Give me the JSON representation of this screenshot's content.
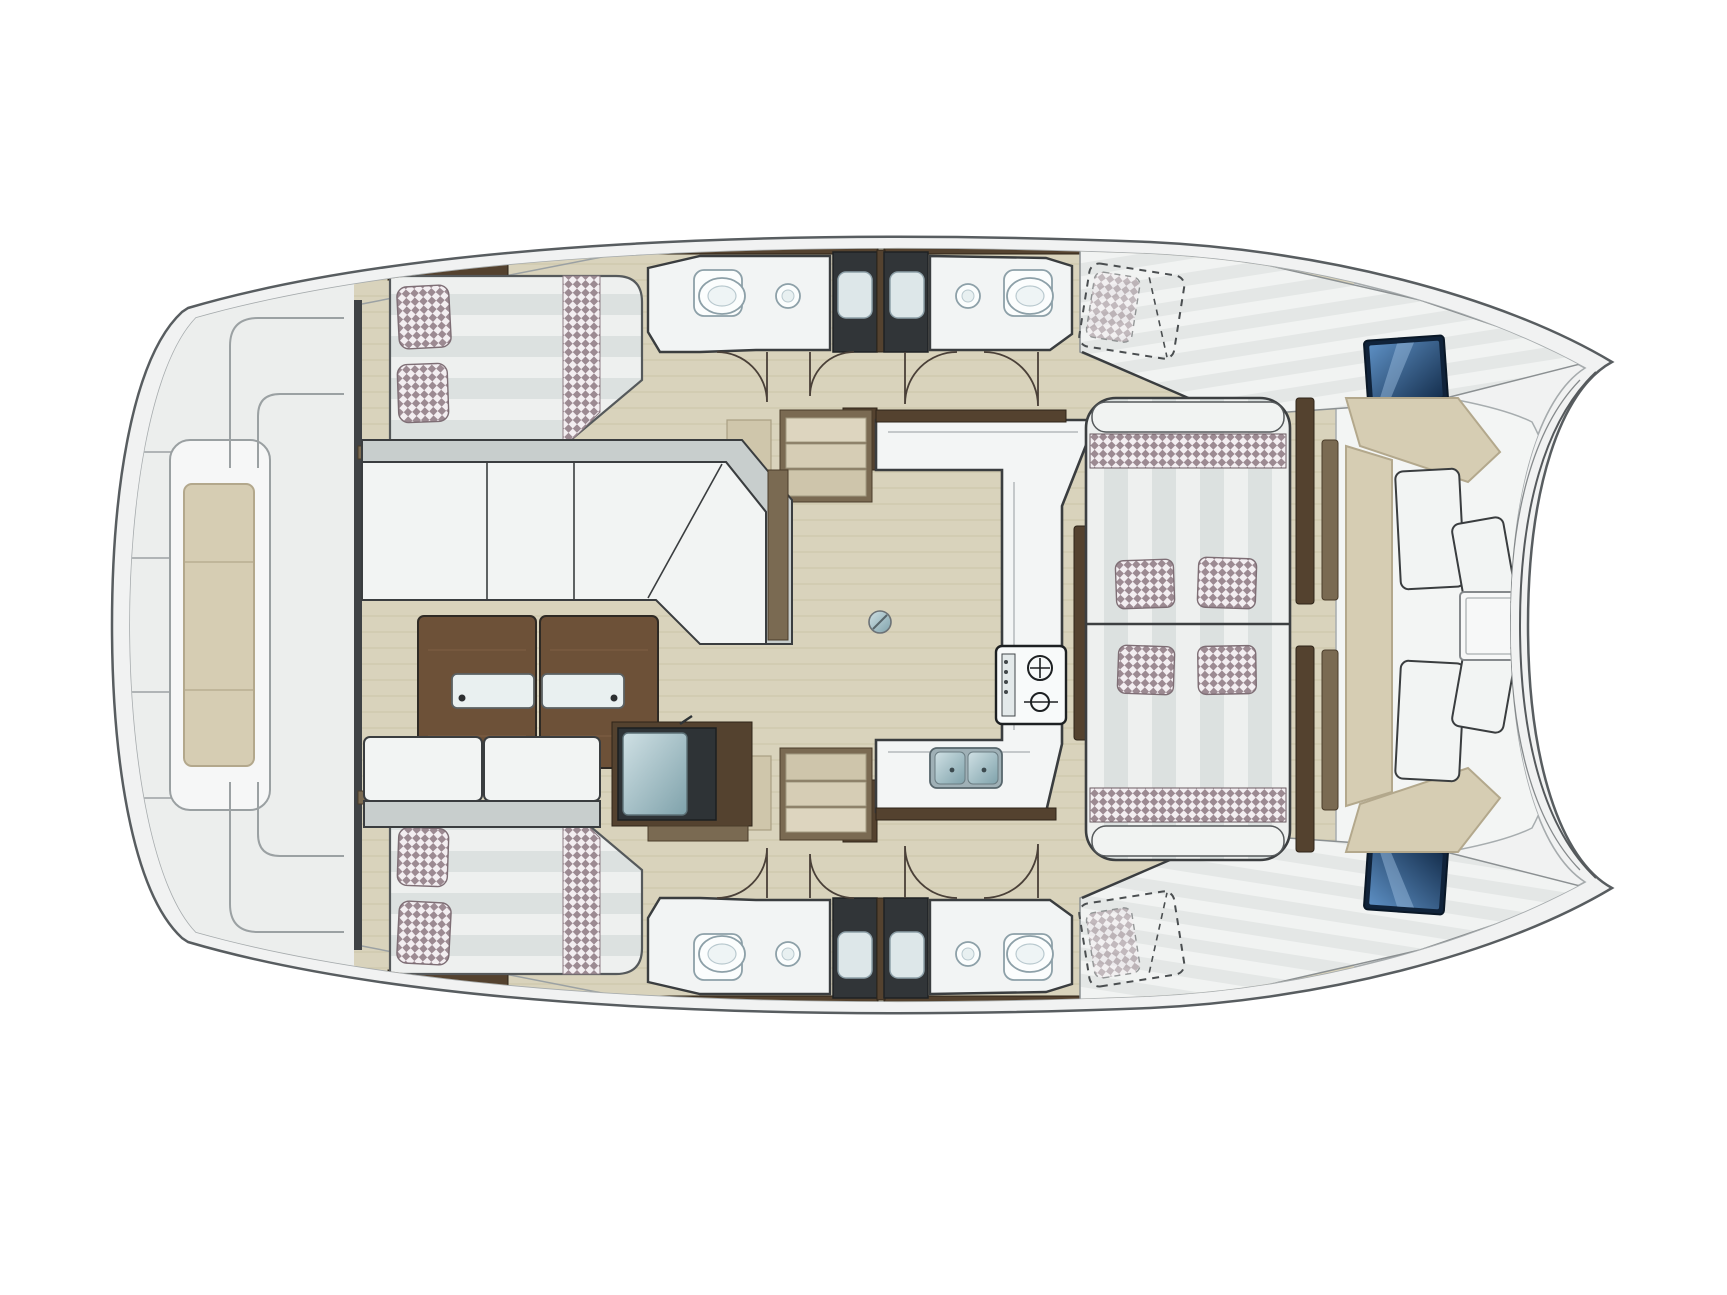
{
  "title": "Catamaran yacht floor plan - top view",
  "colors": {
    "pageBg": "#ffffff",
    "hullFill": "#f1f2f2",
    "hullLine": "#585d60",
    "innerLine": "#a6abad",
    "deckFill": "#eceeed",
    "deckLine": "#9ba1a3",
    "outline": "#3a3d3f",
    "doorLine": "#4a4038",
    "floorWood": "#d9d3bc",
    "floorGrain": "#c4bca0",
    "roomFloor": "#f2f4f4",
    "woodDark": "#54422f",
    "woodMid": "#7a6a52",
    "woodLight": "#cfc6ab",
    "woodTable": "#6d5138",
    "cushionWhite": "#f2f4f3",
    "cushionGray": "#c8cecd",
    "stripeLight": "#eef0ef",
    "stripeDark": "#dce1e0",
    "checkerBase": "#f3eef1",
    "checkerTint": "#9c8a92",
    "tanCushion": "#d6cdb3",
    "tanBorder": "#b3a88c",
    "showerDark": "#313538",
    "trayFill": "#dde7e9",
    "porcelain": "#fbfdfd",
    "fixtureLine": "#8da0a8",
    "steelLight": "#cfe0e4",
    "steelDark": "#7fa2ab",
    "hatchLight": "#5c8ec2",
    "hatchDark": "#16304f"
  },
  "rooms": {
    "plan": "Catamaran yacht floor plan - top view",
    "aftDeck": "Aft deck with transom steps",
    "sternSeat": "Stern bench seat",
    "portAftCabin": "Port aft cabin double berth",
    "starboardSide": "Starboard hull (mirrored layout)",
    "saloon": "Saloon settee",
    "coffeeTable": "Saloon coffee table",
    "saloonBench": "Saloon bench seat",
    "icebox": "Icebox / top-loading fridge",
    "galley": "U-shaped galley",
    "stove": "Two-burner stove",
    "sink": "Double galley sink",
    "portHeads": "Port heads with shower",
    "stairs": "Companionway steps to hull",
    "dinette": "Facing dinette lounge with pillows",
    "forwardCockpit": "Forward cockpit seating",
    "cockpitTable": "Forward cockpit table",
    "forwardBerth": "Forward berth (dashed option)",
    "bowHatch": "Bow deck hatch",
    "doors": "Cabin door swing"
  }
}
